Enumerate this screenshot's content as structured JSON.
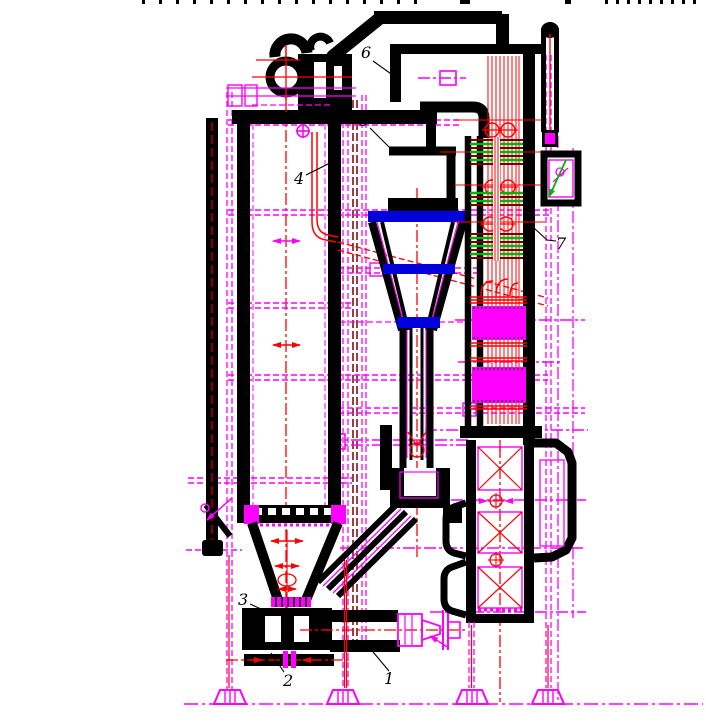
{
  "drawing": {
    "description_visible_text_only": true,
    "callouts": [
      "1",
      "2",
      "3",
      "4",
      "5",
      "6",
      "7"
    ],
    "colors": {
      "structure_black": "#000000",
      "centerline_magenta": "#FF00FF",
      "detail_red": "#FF0000",
      "cyclone_band_blue": "#0000DD",
      "tube_bundle_green": "#00B400",
      "tube_bundle_maroon": "#7A0000",
      "background": "#FFFFFF"
    }
  }
}
